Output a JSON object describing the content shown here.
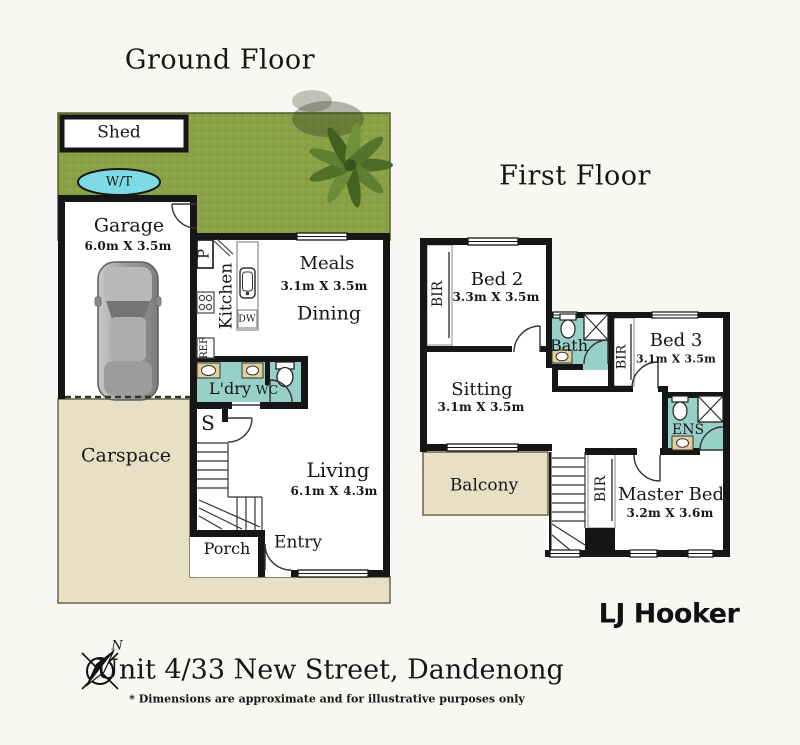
{
  "ground_floor": {
    "title": "Ground Floor",
    "labels": {
      "shed": "Shed",
      "water_tank": "W/T",
      "garage": "Garage",
      "garage_dims": "6.0m X 3.5m",
      "pantry": "P",
      "kitchen": "Kitchen",
      "dishwasher": "DW",
      "fridge": "REF",
      "meals": "Meals",
      "meals_dims": "3.1m X 3.5m",
      "dining": "Dining",
      "laundry": "L'dry",
      "wc": "WC",
      "store": "S",
      "carspace": "Carspace",
      "living": "Living",
      "living_dims": "6.1m X 4.3m",
      "porch": "Porch",
      "entry": "Entry"
    }
  },
  "first_floor": {
    "title": "First Floor",
    "labels": {
      "bed2": "Bed 2",
      "bed2_dims": "3.3m X 3.5m",
      "bir_bed2": "BIR",
      "bath": "Bath",
      "bed3": "Bed 3",
      "bed3_dims": "3.1m X 3.5m",
      "bir_bed3": "BIR",
      "sitting": "Sitting",
      "sitting_dims": "3.1m X 3.5m",
      "balcony": "Balcony",
      "ensuite": "ENS",
      "bir_master": "BIR",
      "master": "Master Bed",
      "master_dims": "3.2m X 3.6m"
    }
  },
  "footer": {
    "brand": "LJ Hooker",
    "address": "Unit 4/33 New Street, Dandenong",
    "disclaimer": "* Dimensions are approximate and for illustrative purposes only",
    "compass_north": "N"
  },
  "colors": {
    "wall": "#161616",
    "grass": "#8ba147",
    "paving": "#e8dfc5",
    "wet_area": "#96d0c9",
    "water_tank": "#7edbe6",
    "room_floor": "#ffffff"
  }
}
